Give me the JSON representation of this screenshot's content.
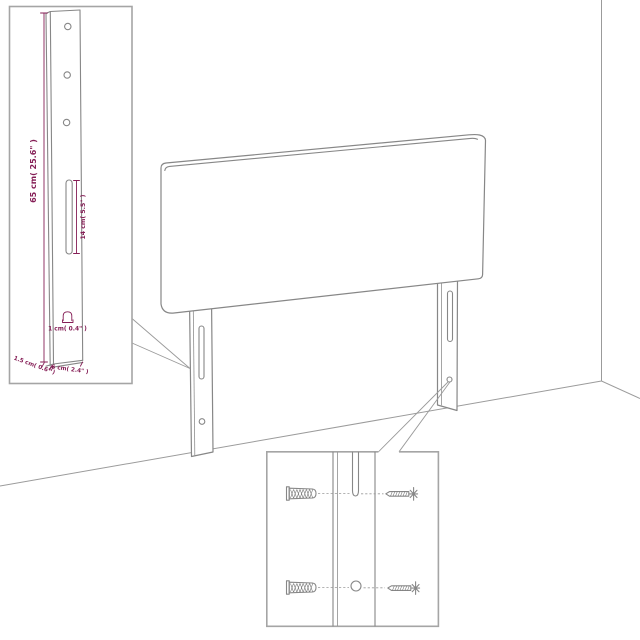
{
  "canvas": {
    "width": 640,
    "height": 640,
    "background": "#ffffff"
  },
  "colors": {
    "artwork_line": "#878787",
    "wall_line": "#9b9b9b",
    "inset_border": "#a5a5a5",
    "dimension": "#851e56"
  },
  "leg_detail_inset": {
    "height_label": "65 cm( 25.6\" )",
    "slot_label": "14 cm( 5.5\" )",
    "hook_label": "1 cm( 0.4\" )",
    "side_label": "1.5 cm( 0.6\" )",
    "width_label": "6 cm( 2.4\" )"
  }
}
